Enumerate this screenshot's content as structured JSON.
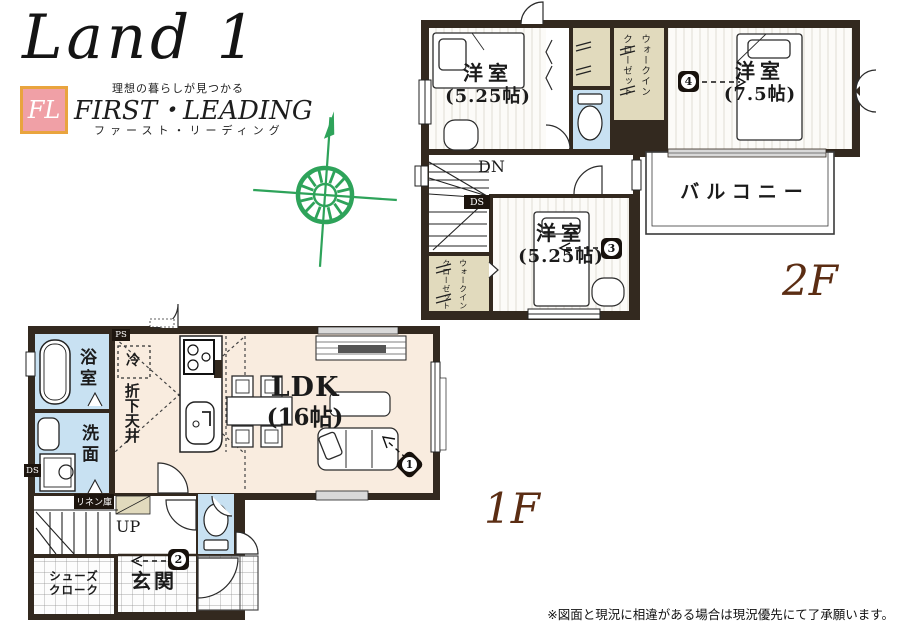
{
  "branding": {
    "logo": "Land 1",
    "tagline": "理想の暮らしが見つかる",
    "monogram": "FL",
    "company_en": "FIRST・LEADING",
    "company_kana": "ファースト・リーディング"
  },
  "floor2": {
    "label": "2F",
    "bedroom_a_name": "洋室",
    "bedroom_a_size": "(5.25帖)",
    "bedroom_b_name": "洋室",
    "bedroom_b_size": "(7.5帖)",
    "bedroom_c_name": "洋室",
    "bedroom_c_size": "(5.25帖)",
    "balcony": "バルコニー",
    "walk_in_closet": "ウォークイン\nクローゼット",
    "down": "DN",
    "duct": "DS",
    "marker3": "3",
    "marker4": "4"
  },
  "floor1": {
    "label": "1F",
    "bath": "浴室",
    "washroom": "洗面",
    "ldk_name": "LDK",
    "ldk_size": "(16帖)",
    "fridge": "冷",
    "dropped_ceiling": "折下天井",
    "linen": "リネン庫",
    "up": "UP",
    "shoe_closet": "シューズ\nクローク",
    "entrance": "玄関",
    "pipe_space": "PS",
    "duct": "DS",
    "marker1": "1",
    "marker2": "2"
  },
  "disclaimer": "※図面と現況に相違がある場合は現況優先にて了承願います。",
  "colors": {
    "wall": "#33291f",
    "ldk_floor": "#f9ecdf",
    "wet_room": "#c8e1f2",
    "closet": "#e1dabd",
    "floor_label": "#5b2d13",
    "compass": "#2ea35a",
    "fl_box_bg": "#f0a0a6",
    "fl_box_border": "#e9a43e"
  }
}
